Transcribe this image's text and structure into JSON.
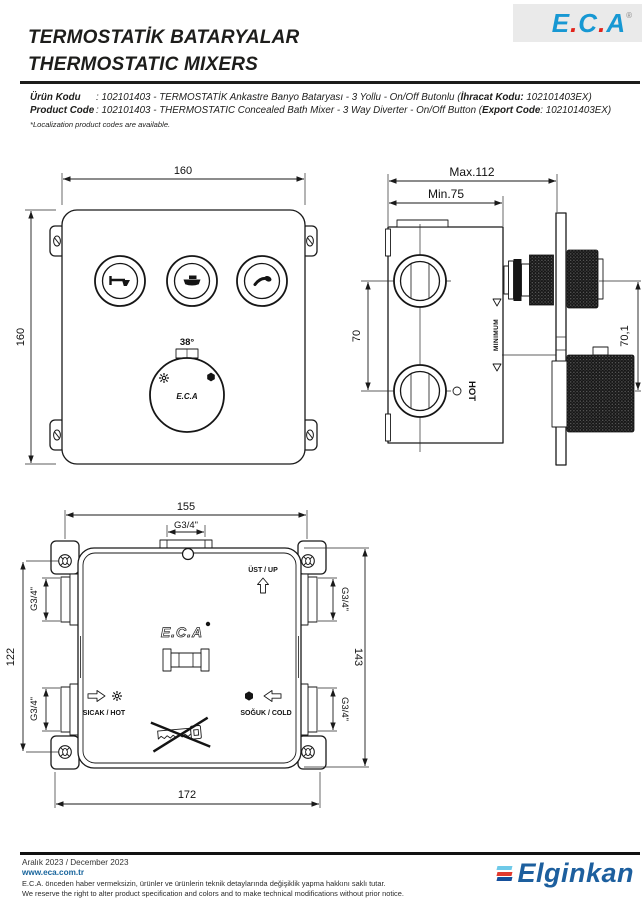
{
  "header": {
    "title_tr": "TERMOSTATİK BATARYALAR",
    "title_en": "THERMOSTATIC MIXERS",
    "logo": {
      "l1": "E",
      "d1": ".",
      "l2": "C",
      "d2": ".",
      "l3": "A",
      "reg": "®"
    }
  },
  "product": {
    "label_tr": "Ürün Kodu",
    "colon_tr": ": ",
    "desc_tr": "102101403 - TERMOSTATİK Ankastre Banyo Bataryası - 3 Yollu - On/Off Butonlu (",
    "export_label_tr": "İhracat Kodu:",
    "export_tail_tr": " 102101403EX)",
    "label_en": "Product Code",
    "colon_en": ": ",
    "desc_en": "102101403 - THERMOSTATIC Concealed Bath Mixer - 3 Way Diverter - On/Off Button (",
    "export_label_en": "Export Code",
    "export_tail_en": ": 102101403EX)",
    "note": "*Localization product codes are available."
  },
  "drawings": {
    "front_view": {
      "width": "160",
      "height": "160",
      "temp": "38°",
      "brand": "E.C.A"
    },
    "side_view": {
      "max_depth": "Max.112",
      "min_depth": "Min.75",
      "port_spacing": "70",
      "handle_spacing": "70,1",
      "minimum": "MINIMUM",
      "hot": "HOT"
    },
    "back_view": {
      "screw_spacing_h": "155",
      "screw_spacing_v": "122",
      "height": "143",
      "width": "172",
      "top_port": "G3/4\"",
      "left_top": "G3/4\"",
      "left_bottom": "G3/4\"",
      "right_top": "G3/4\"",
      "right_bottom": "G3/4\"",
      "up": "ÜST / UP",
      "hot": "SICAK / HOT",
      "cold": "SOĞUK / COLD",
      "brand": "E.C.A"
    }
  },
  "footer": {
    "date": "Aralık 2023 / December 2023",
    "website": "www.eca.com.tr",
    "disclaimer_tr": "E.C.A. önceden haber vermeksizin, ürünler ve ürünlerin teknik detaylarında değişiklik yapma hakkını saklı tutar.",
    "disclaimer_en": "We reserve the right to alter product specification and colors and to make technical modifications without prior notice.",
    "brand": "Elginkan"
  },
  "colors": {
    "eca_blue": "#1798d3",
    "logo_dot_red": "#e2231a",
    "link_blue": "#17649c",
    "elginkan_blue": "#1d5f9e",
    "bar_light_blue": "#6ec9e8",
    "bar_red": "#e23a2e",
    "bar_dark_blue": "#154f9b",
    "line_black": "#1a1a1a"
  }
}
